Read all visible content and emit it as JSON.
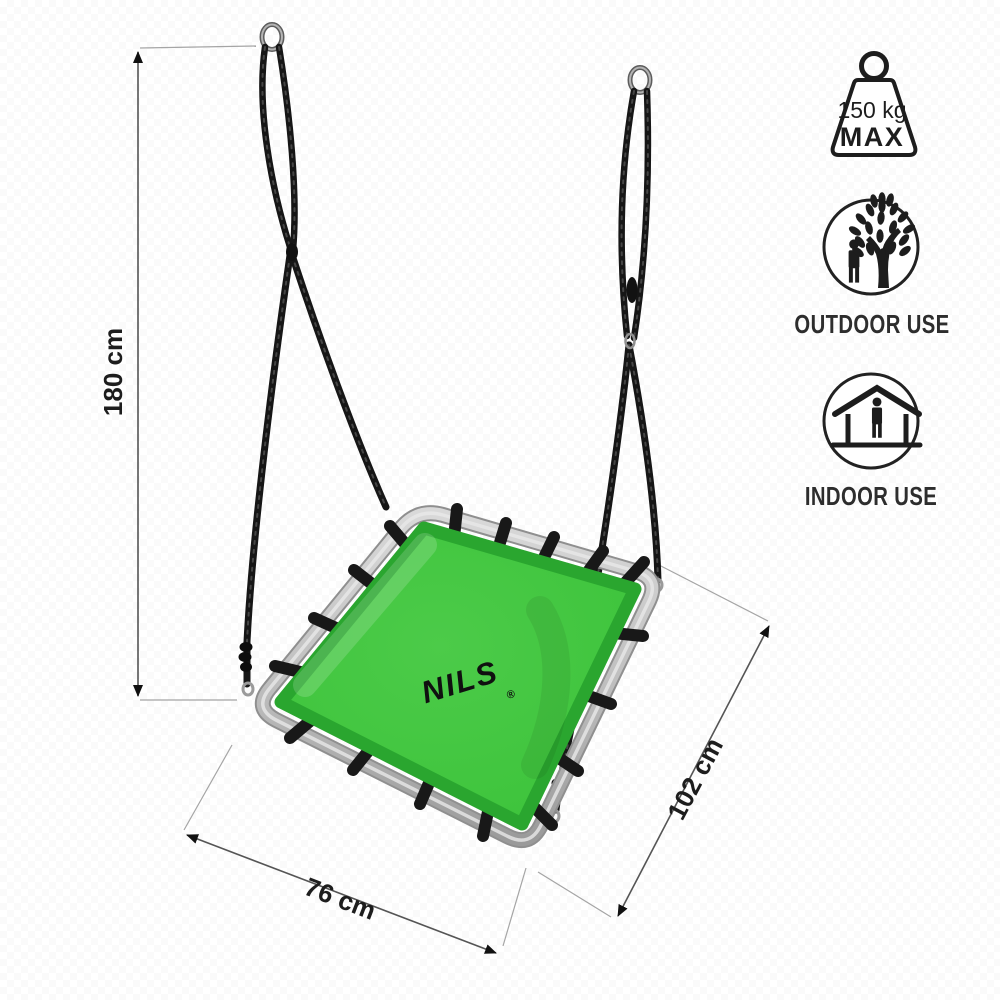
{
  "product": {
    "brand": "NILS",
    "registered_mark": "®",
    "description": "Rectangular nest swing with steel frame, black straps and green mat hanging on two black ropes"
  },
  "dimensions": {
    "height": "180 cm",
    "width": "76 cm",
    "length": "102 cm"
  },
  "badges": {
    "max_load": {
      "value": "150 kg",
      "label": "MAX",
      "icon": "weight-icon"
    },
    "outdoor": {
      "label": "OUTDOOR USE",
      "icon": "person-tree-icon"
    },
    "indoor": {
      "label": "INDOOR USE",
      "icon": "person-house-icon"
    }
  },
  "colors": {
    "mat_green": "#3ec43c",
    "mat_border_green": "#2aa62f",
    "frame_silver": "#c4c4c4",
    "strap_black": "#181818",
    "rope_black": "#161616",
    "dimension_line": "#555555",
    "extension_line": "#a5a5a5",
    "icon_ink": "#1d1d1d"
  }
}
